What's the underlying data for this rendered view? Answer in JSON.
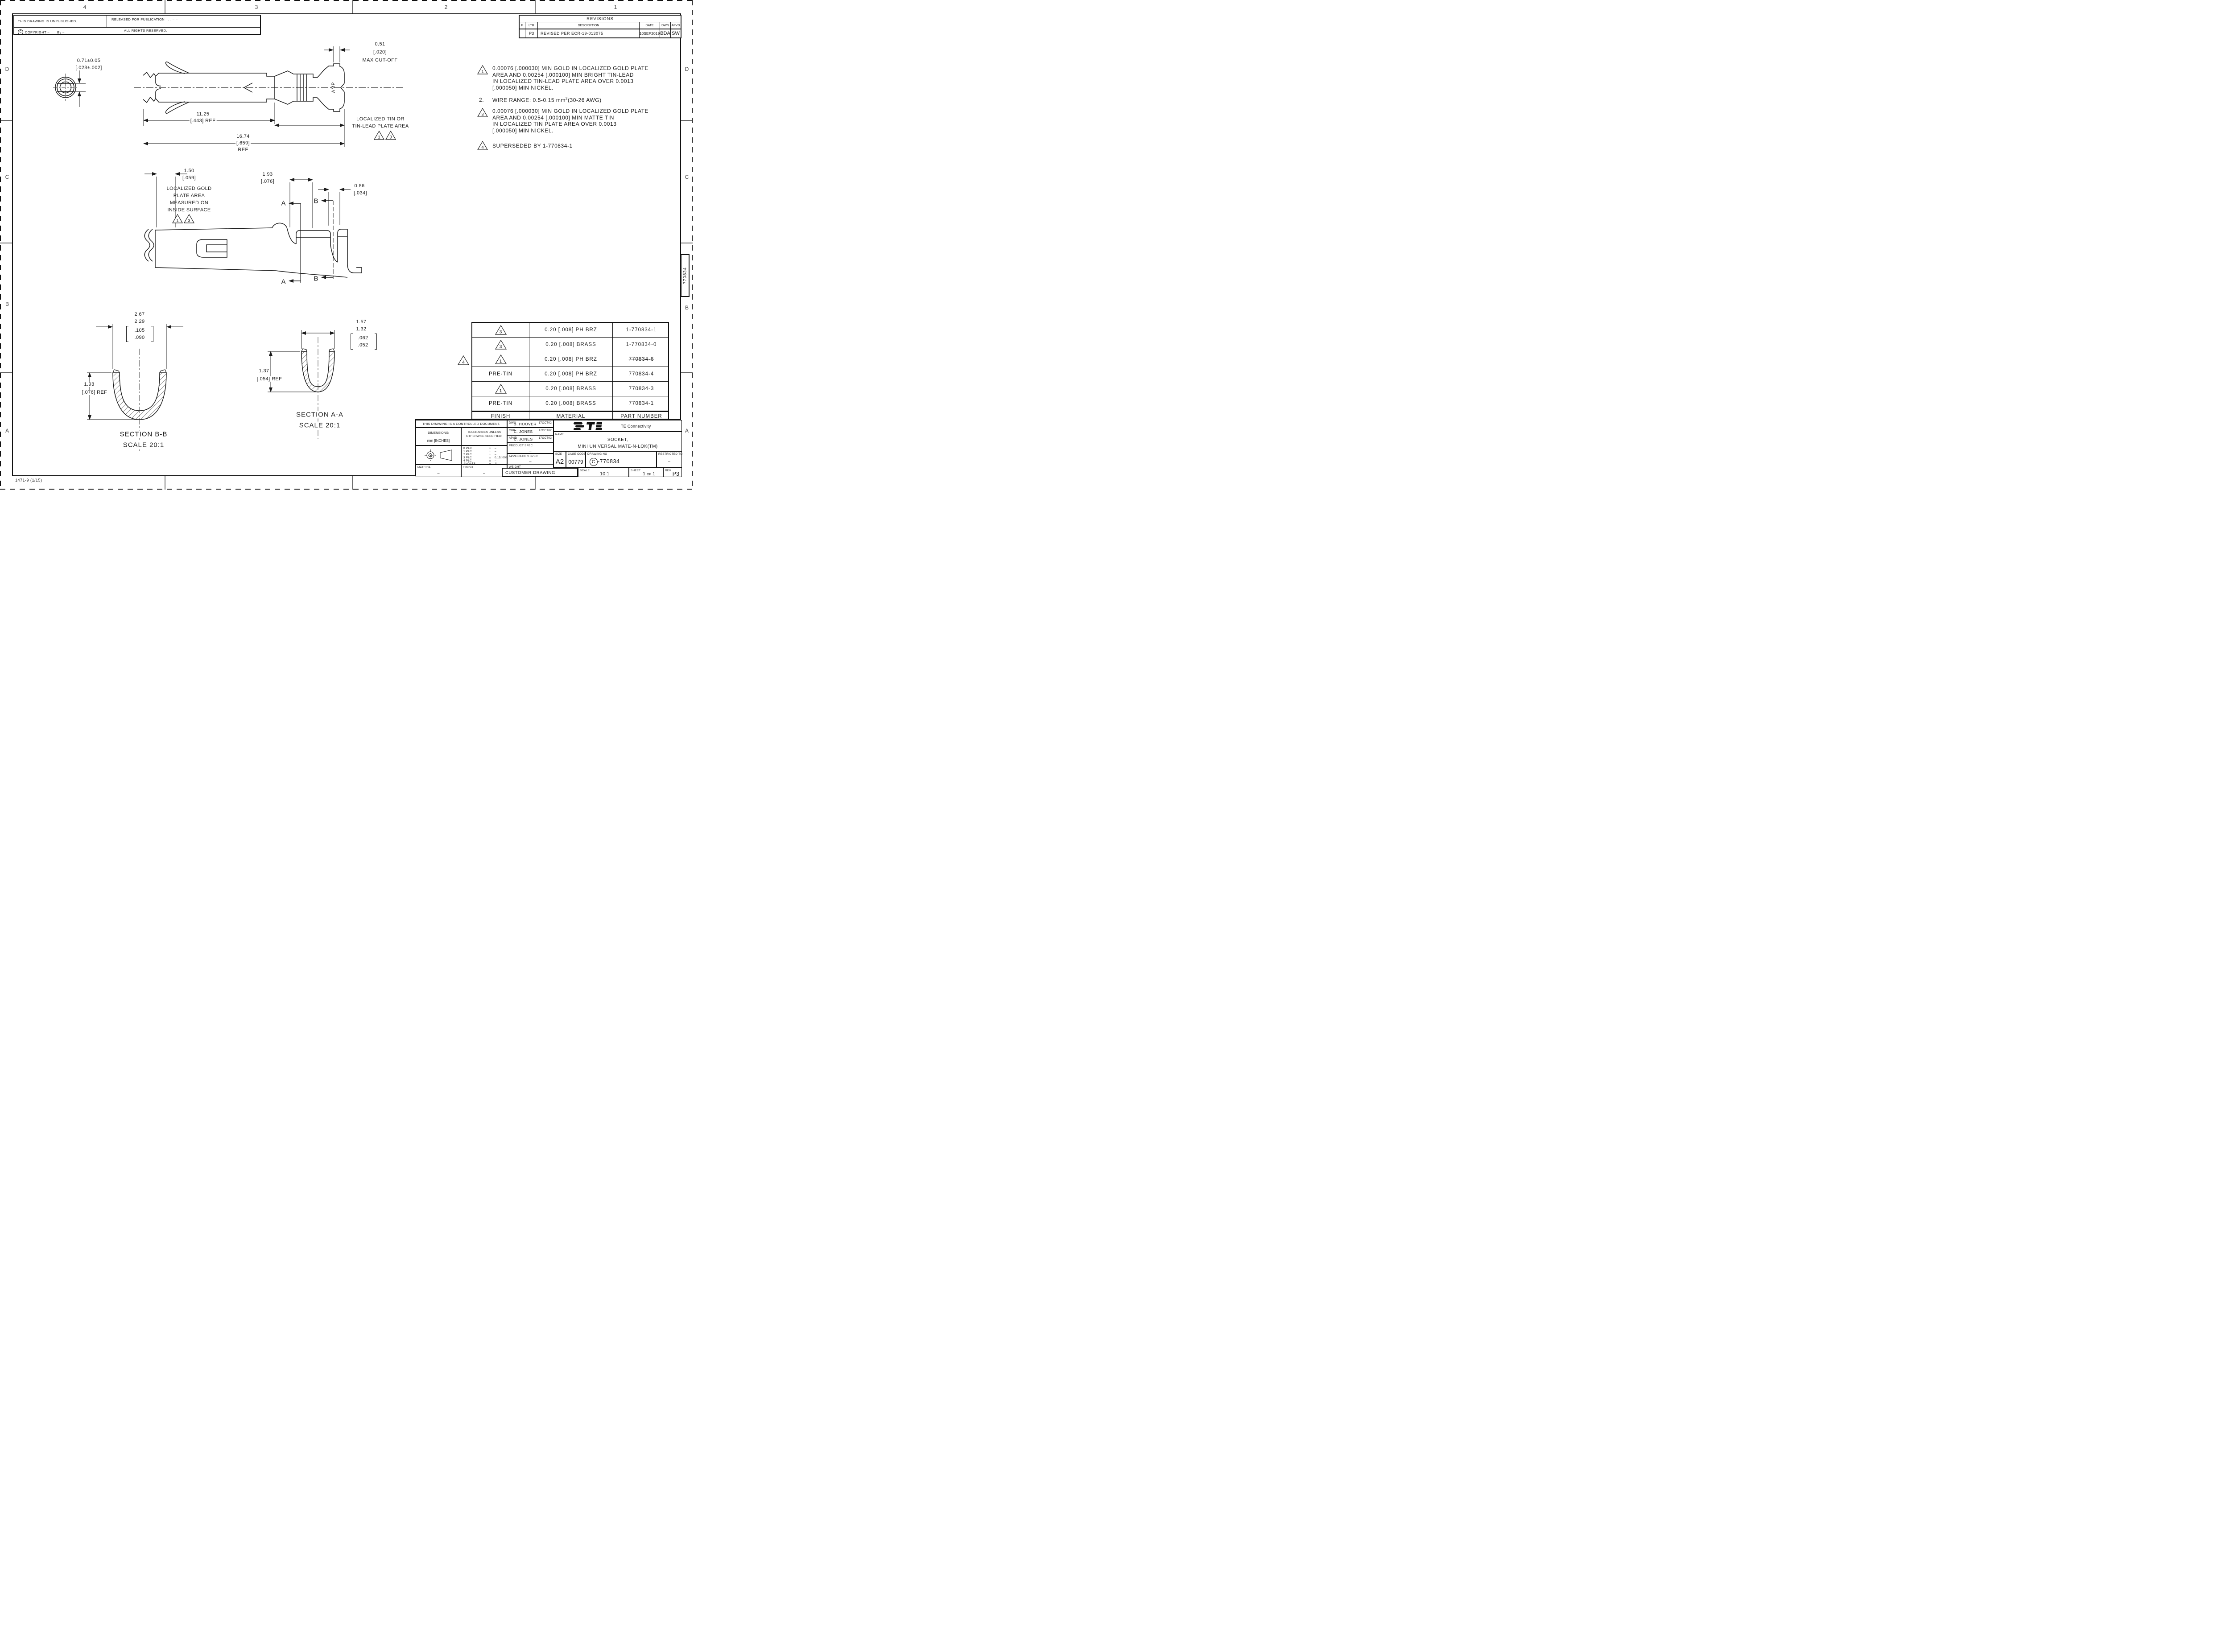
{
  "sheet": {
    "footer_code": "1471-9  (1/15)",
    "stub_number": "770834"
  },
  "zones": {
    "top": [
      "4",
      "3",
      "2",
      "1"
    ],
    "left": [
      "D",
      "C",
      "B",
      "A"
    ],
    "right": [
      "D",
      "C",
      "B",
      "A"
    ]
  },
  "header": {
    "unpublished": "THIS DRAWING IS UNPUBLISHED.",
    "released": "RELEASED FOR PUBLICATION",
    "released_marks": ",   .      –      –",
    "rights": "ALL RIGHTS RESERVED.",
    "copyright_symbol": "C",
    "copyright": "COPYRIGHT   –",
    "by_label": "By –"
  },
  "revisions": {
    "title": "REVISIONS",
    "headers": {
      "p": "P",
      "ltr": "LTR",
      "desc": "DESCRIPTION",
      "date": "DATE",
      "dwn": "DWN",
      "apvd": "APVD"
    },
    "rows": [
      {
        "ltr": "P3",
        "desc": "REVISED PER ECR-19-013075",
        "date": "10SEP2019",
        "dwn": "BDA",
        "apvd": "SW"
      }
    ]
  },
  "notes": {
    "n1": {
      "flag": "1",
      "l0": "0.00076 [.000030] MIN GOLD IN LOCALIZED GOLD PLATE",
      "l1": "AREA AND 0.00254 [.000100] MIN BRIGHT TIN-LEAD",
      "l2": "IN LOCALIZED TIN-LEAD PLATE AREA OVER 0.0013",
      "l3": "[.000050] MIN NICKEL."
    },
    "n2": {
      "num": "2.",
      "text": "WIRE RANGE: 0.5-0.15 mm",
      "sup": "2",
      "text2": "(30-26 AWG)"
    },
    "n3": {
      "flag": "3",
      "l0": "0.00076 [.000030] MIN GOLD IN LOCALIZED GOLD PLATE",
      "l1": "AREA AND 0.00254 [.000100] MIN MATTE TIN",
      "l2": "IN LOCALIZED TIN PLATE AREA OVER 0.0013",
      "l3": "[.000050] MIN NICKEL."
    },
    "n4": {
      "flag": "4",
      "text": "SUPERSEDED BY 1-770834-1"
    }
  },
  "view1": {
    "tip_mm": "0.71±0.05",
    "tip_in": "[.028±.002]",
    "cutoff_mm": "0.51",
    "cutoff_in": "[.020]",
    "cutoff_label": "MAX CUT-OFF",
    "len1_mm": "11.25",
    "len1_in": "[.443] REF",
    "len2_mm": "16.74",
    "len2_in": "[.659]",
    "len2_ref": "REF",
    "tin_l0": "LOCALIZED TIN OR",
    "tin_l1": "TIN-LEAD PLATE AREA",
    "flag1": "1",
    "flag3": "3",
    "brand": "AMP"
  },
  "view2": {
    "gold_mm": "1.50",
    "gold_in": "[.059]",
    "gold_l0": "LOCALIZED GOLD",
    "gold_l1": "PLATE AREA",
    "gold_l2": "MEASURED ON",
    "gold_l3": "INSIDE SURFACE",
    "flag1": "1",
    "flag3": "3",
    "w1_mm": "1.93",
    "w1_in": "[.076]",
    "w2_mm": "0.86",
    "w2_in": "[.034]",
    "secA": "A",
    "secB": "B"
  },
  "sectionBB": {
    "d_mm1": "2.67",
    "d_mm2": "2.29",
    "d_in1": ".105",
    "d_in2": ".090",
    "h_mm": "1.93",
    "h_in": "[.076] REF",
    "cap": "SECTION B-B",
    "scale": "SCALE 20:1"
  },
  "sectionAA": {
    "d_mm1": "1.57",
    "d_mm2": "1.32",
    "d_in1": ".062",
    "d_in2": ".052",
    "h_mm": "1.37",
    "h_in": "[.054] REF",
    "cap": "SECTION A-A",
    "scale": "SCALE 20:1"
  },
  "material": {
    "rows": [
      {
        "flag": "3",
        "finish": "",
        "material": "0.20 [.008] PH BRZ",
        "part": "1-770834-1"
      },
      {
        "flag": "3",
        "finish": "",
        "material": "0.20 [.008] BRASS",
        "part": "1-770834-0"
      },
      {
        "flag": "1",
        "finish": "",
        "material": "0.20 [.008] PH BRZ",
        "part": "770834-6"
      },
      {
        "flag": "",
        "finish": "PRE-TIN",
        "material": "0.20 [.008] PH BRZ",
        "part": "770834-4"
      },
      {
        "flag": "1",
        "finish": "",
        "material": "0.20 [.008] BRASS",
        "part": "770834-3"
      },
      {
        "flag": "",
        "finish": "PRE-TIN",
        "material": "0.20 [.008] BRASS",
        "part": "770834-1"
      }
    ],
    "footer": {
      "finish": "FINISH",
      "material": "MATERIAL",
      "part": "PART NUMBER"
    },
    "side_flag": "4"
  },
  "title_block": {
    "controlled": "THIS DRAWING IS A CONTROLLED DOCUMENT.",
    "dimensions_label": "DIMENSIONS:",
    "units": "mm [INCHES]",
    "tol_l0": "TOLERANCES UNLESS",
    "tol_l1": "OTHERWISE SPECIFIED:",
    "tol": [
      {
        "k": "0 PLC",
        "pm": "±",
        "v": "–"
      },
      {
        "k": "1 PLC",
        "pm": "±",
        "v": "–"
      },
      {
        "k": "2 PLC",
        "pm": "±",
        "v": "–"
      },
      {
        "k": "3 PLC",
        "pm": "±",
        "v": "0.15[.006]"
      },
      {
        "k": "4 PLC",
        "pm": "±",
        "v": "–"
      },
      {
        "k": "ANGLES",
        "pm": "±",
        "v": "1°"
      }
    ],
    "material_label": "MATERIAL",
    "material_value": "–",
    "finish_label": "FINISH",
    "finish_value": "–",
    "dwn_label": "DWN",
    "dwn_name": "S. HOOVER",
    "dwn_date": "17OCT02",
    "chk_label": "CHK",
    "chk_name": "C. JONES",
    "chk_date": "17OCT02",
    "apvd_label": "APVD",
    "apvd_name": "C. JONES",
    "apvd_date": "17OCT02",
    "product_label": "PRODUCT SPEC",
    "product_value": "–",
    "app_label": "APPLICATION SPEC",
    "app_value": "–",
    "weight_label": "WEIGHT",
    "customer": "CUSTOMER DRAWING",
    "brand_name": "TE Connectivity",
    "name_label": "NAME",
    "name_l0": "SOCKET,",
    "name_l1": "MINI UNIVERSAL MATE-N-LOK(TM)",
    "size_label": "SIZE",
    "size": "A2",
    "cage_label": "CAGE CODE",
    "cage": "00779",
    "dwg_label": "DRAWING NO",
    "dwg_prefix": "C",
    "dwg_no": "-770834",
    "restricted_label": "RESTRICTED TO",
    "restricted_value": "–",
    "scale_label": "SCALE",
    "scale": "10:1",
    "sheet_label": "SHEET",
    "sheet_no": "1",
    "sheet_of": "OF",
    "sheet_total": "1",
    "rev_label": "REV",
    "rev": "P3"
  }
}
